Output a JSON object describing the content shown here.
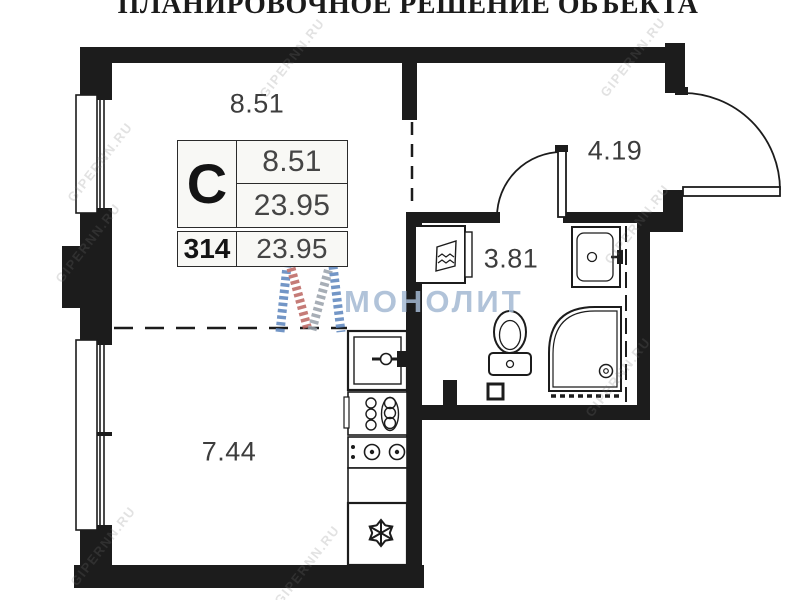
{
  "title": "ПЛАНИРОВОЧНОЕ РЕШЕНИЕ ОБЪЕКТА",
  "unit_card": {
    "type_letter": "С",
    "zone_area": "8.51",
    "total_area": "23.95",
    "unit_number": "314",
    "total_area_repeat": "23.95"
  },
  "room_labels": {
    "kitchen_zone": "8.51",
    "hallway": "4.19",
    "bathroom": "3.81",
    "living_zone": "7.44"
  },
  "watermarks": {
    "brand": "МОНОЛИТ",
    "portal": "GIPERNN.RU"
  },
  "icons": {
    "kitchen": [
      "sink-icon",
      "dish-drainer-icon",
      "hob-2-burner-icon",
      "fridge-snowflake-icon"
    ],
    "bathroom": [
      "washing-machine-icon",
      "toilet-icon",
      "washbasin-icon",
      "shower-cabin-icon",
      "pipe-shaft-icon"
    ],
    "doors": [
      "entrance-door-swing-icon",
      "bathroom-door-swing-icon"
    ]
  },
  "colors": {
    "wall": "#1c1c1c",
    "background": "#ffffff",
    "card_background": "#f8f8f5",
    "label_text": "#3d3d3d",
    "brand_watermark": "#a3b8d2",
    "logo_blue": "#5b84bd",
    "logo_red": "#bc6460",
    "logo_gray": "#98a0aa"
  }
}
